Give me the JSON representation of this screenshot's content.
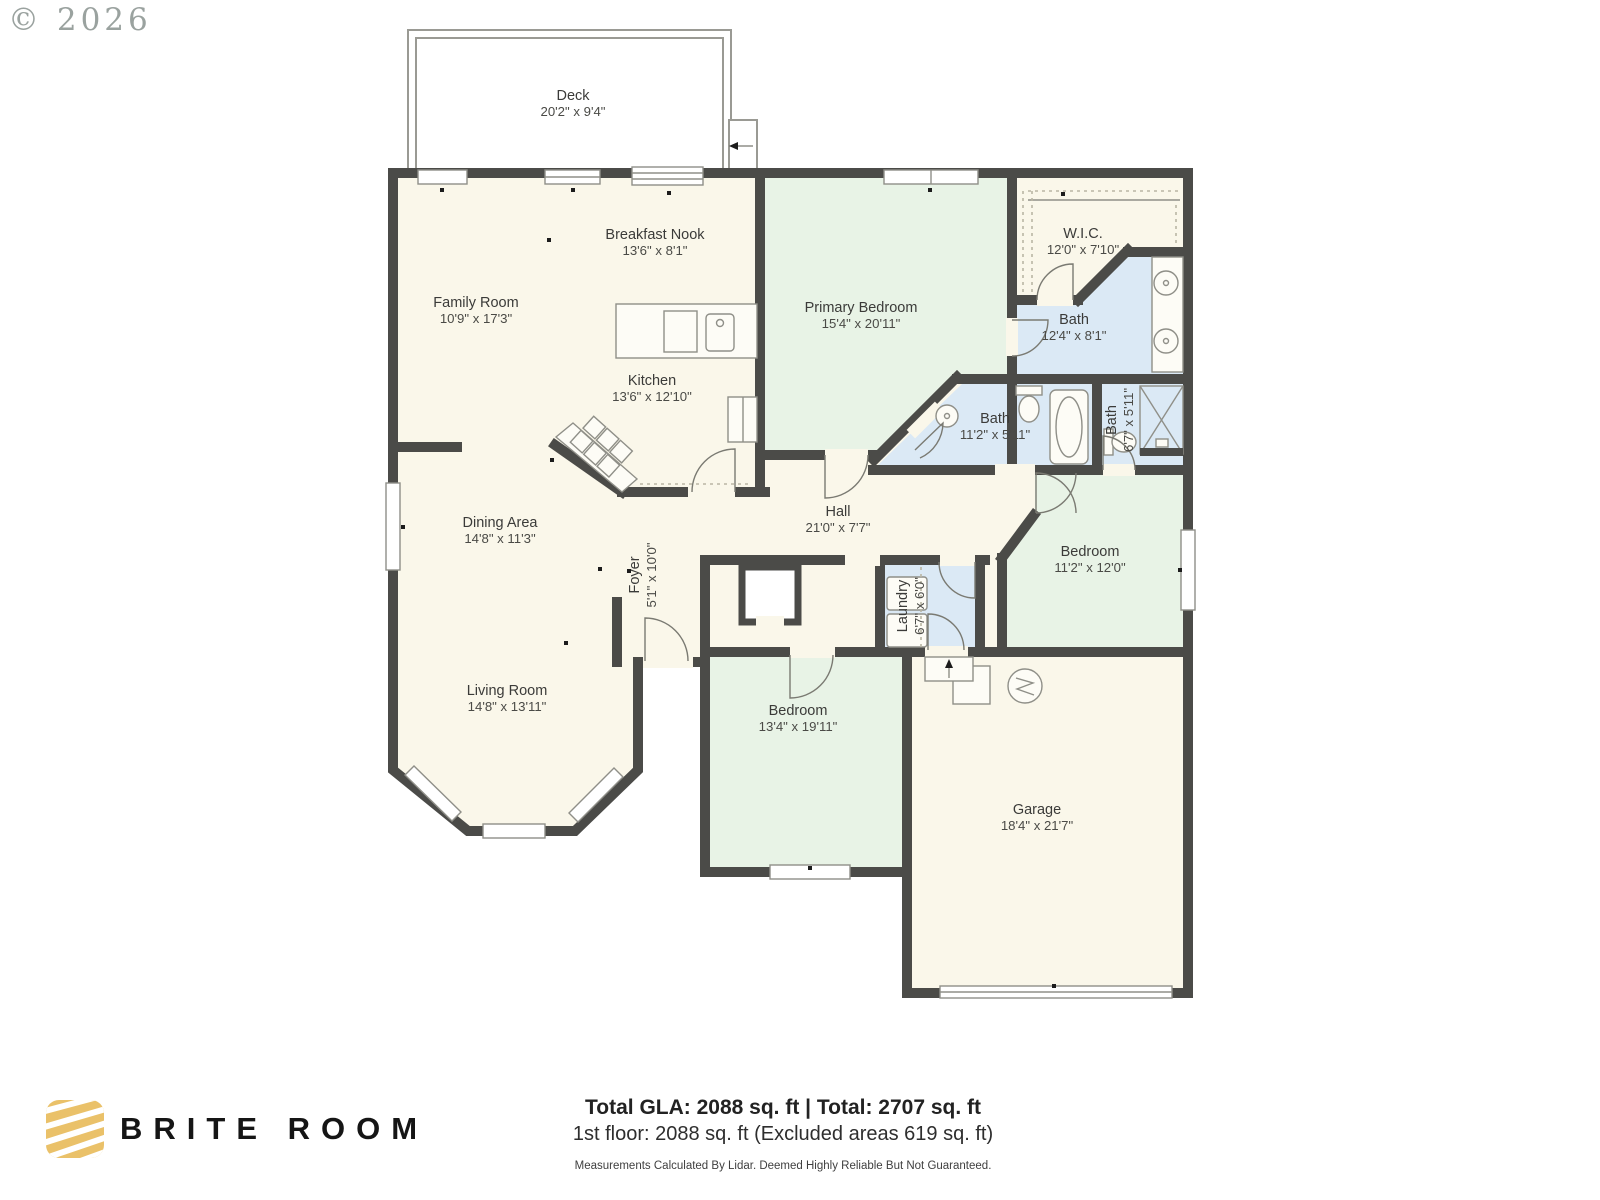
{
  "watermark": {
    "copyright": "© 2026"
  },
  "rooms": {
    "deck": {
      "name": "Deck",
      "dims": "20'2\" x 9'4\""
    },
    "family_room": {
      "name": "Family Room",
      "dims": "10'9\" x 17'3\""
    },
    "breakfast_nook": {
      "name": "Breakfast Nook",
      "dims": "13'6\" x 8'1\""
    },
    "kitchen": {
      "name": "Kitchen",
      "dims": "13'6\" x 12'10\""
    },
    "primary_bedroom": {
      "name": "Primary Bedroom",
      "dims": "15'4\" x 20'11\""
    },
    "wic": {
      "name": "W.I.C.",
      "dims": "12'0\" x 7'10\""
    },
    "primary_bath": {
      "name": "Bath",
      "dims": "12'4\" x 8'1\""
    },
    "hall_bath": {
      "name": "Bath",
      "dims": "11'2\" x 5'11\""
    },
    "corner_bath": {
      "name": "Bath",
      "dims": "6'7\" x 5'11\""
    },
    "hall": {
      "name": "Hall",
      "dims": "21'0\" x 7'7\""
    },
    "dining_area": {
      "name": "Dining Area",
      "dims": "14'8\" x 11'3\""
    },
    "foyer": {
      "name": "Foyer",
      "dims": "5'1\" x 10'0\""
    },
    "laundry": {
      "name": "Laundry",
      "dims": "6'7\" x 6'0\""
    },
    "bedroom_right": {
      "name": "Bedroom",
      "dims": "11'2\" x 12'0\""
    },
    "living_room": {
      "name": "Living Room",
      "dims": "14'8\" x 13'11\""
    },
    "bedroom_lower": {
      "name": "Bedroom",
      "dims": "13'4\" x 19'11\""
    },
    "garage": {
      "name": "Garage",
      "dims": "18'4\" x 21'7\""
    }
  },
  "footer": {
    "brand": "BRITE ROOM",
    "totals_line": "Total GLA: 2088 sq. ft | Total: 2707 sq. ft",
    "floor_line": "1st floor: 2088 sq. ft (Excluded areas 619 sq. ft)",
    "disclaimer": "Measurements Calculated By Lidar. Deemed Highly Reliable But Not Guaranteed."
  },
  "colors": {
    "wall": "#4b4b48",
    "floor_cream": "#faf7ea",
    "floor_green": "#e8f3e6",
    "floor_blue": "#dbe9f5",
    "accent_gold": "#eac169"
  }
}
